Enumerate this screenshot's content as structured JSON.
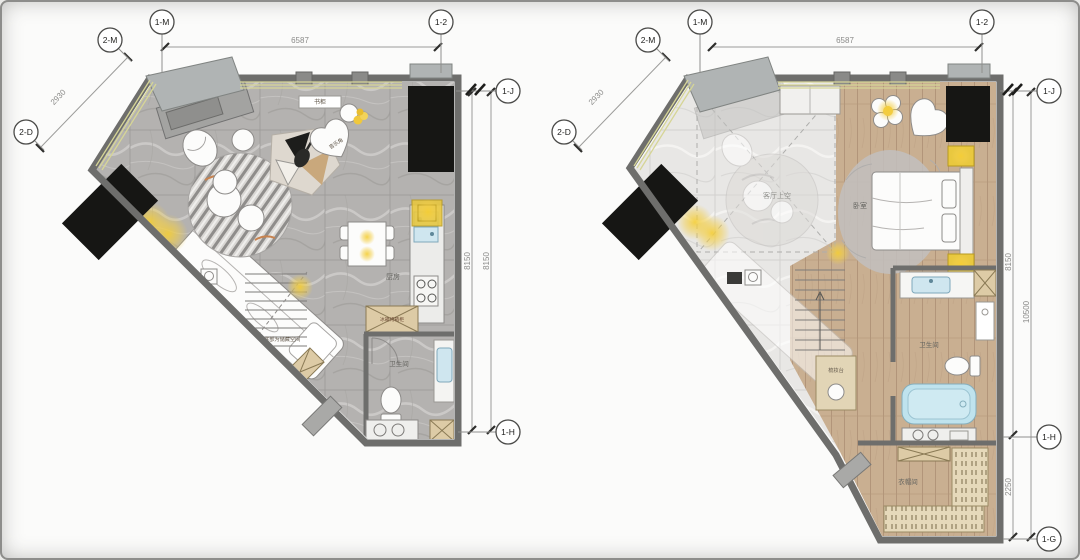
{
  "document": {
    "type": "interior-design floor plans, two-level loft apartment",
    "accent_colors": {
      "glow_yellow": "#f3cf4a",
      "marble_gray": "#b4b2b0",
      "wood_tan": "#c9af91",
      "wall_gray": "#6e6e6c",
      "fixture_blue": "#cfe6ef"
    }
  },
  "plan_left": {
    "dim_top": "6587",
    "dim_diag": "2930",
    "dim_right_a": "8150",
    "dim_right_b": "8150",
    "bubble_top_col": "1-M",
    "bubble_diag_top": "2-M",
    "bubble_diag_left": "2-D",
    "bubble_top_right": "1-2",
    "bubble_right_top": "1-J",
    "bubble_right_bottom": "1-H",
    "label_cabinet": "书柜",
    "label_music": "音乐角",
    "label_kitchen": "厨房",
    "label_appliance": "冰箱烤箱柜",
    "label_bath": "卫生间",
    "label_stairs": "楼梯底部为储藏空间",
    "label_entry": "入口鞋柜"
  },
  "plan_right": {
    "dim_top": "6587",
    "dim_diag": "2930",
    "dim_right_a": "8150",
    "dim_right_b": "10500",
    "dim_right_c": "2250",
    "bubble_top_col": "1-M",
    "bubble_diag_top": "2-M",
    "bubble_diag_left": "2-D",
    "bubble_top_right": "1-2",
    "bubble_right_top": "1-J",
    "bubble_right_mid": "1-H",
    "bubble_right_bottom": "1-G",
    "label_void": "客厅上空",
    "label_bedroom": "卧室",
    "label_bath": "卫生间",
    "label_dresser": "梳妆台",
    "label_closet": "衣帽间"
  }
}
